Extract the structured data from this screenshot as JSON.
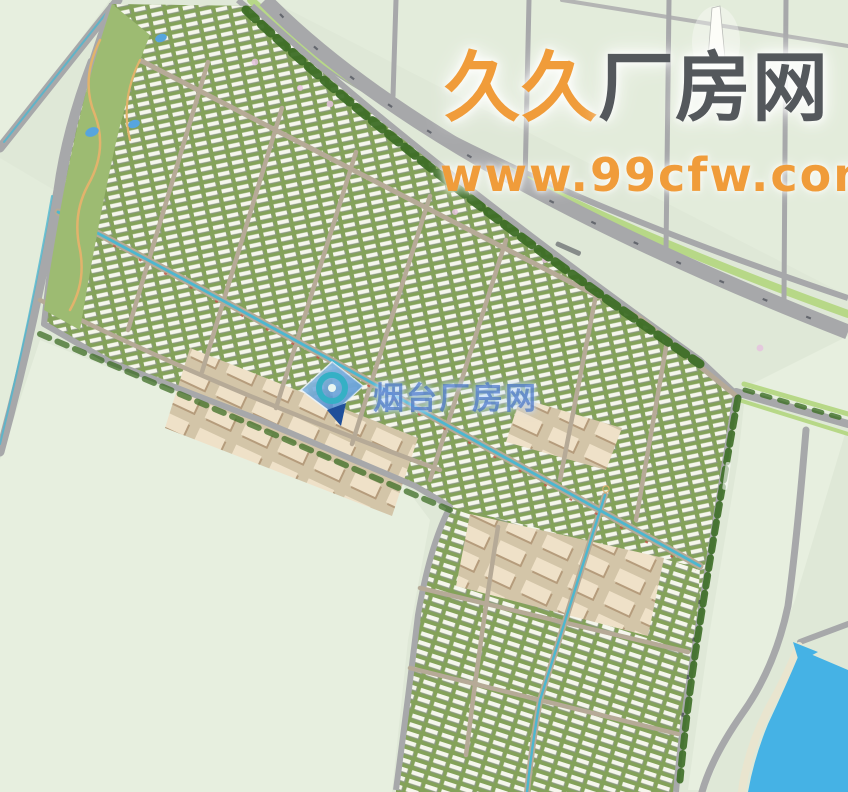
{
  "watermarks": {
    "primary": {
      "brand_prefix": "久久",
      "brand_suffix": "厂房网",
      "url": "www.99cfw.com"
    },
    "secondary": {
      "brand": "烟台厂房网",
      "logo": "diamond-ring-map-pin-logo"
    }
  },
  "map": {
    "kind": "industrial-park-master-plan-aerial-rendering",
    "features": [
      "open-farmland-fields",
      "diagonal-road-network",
      "tree-lined-boulevard",
      "industrial-building-rows",
      "large-warehouse-blocks",
      "canal-lined-avenue",
      "river-bottom-right",
      "small-ponds",
      "white-tower-landmark"
    ]
  },
  "theme": {
    "field": "#dfe8d7",
    "field-light": "#e7efdf",
    "field-mid": "#e3ecdb",
    "road": "#a7a8aa",
    "road-minor": "#b6aa97",
    "band-green": "#84a25a",
    "band-edge": "#9dbb72",
    "building-white": "#f5f6ec",
    "building-shadow": "#8d9a82",
    "big-ground": "#d3c5a8",
    "big-shadow": "#b59c7c",
    "big-fill": "#efe1c8",
    "tree-dark": "#3d6e26",
    "verge": "#b7d887",
    "canal": "#4db7cf",
    "river": "#45b2e5",
    "bank": "#e9e5cf",
    "pond": "#57a5de",
    "garden-path": "#e2b36c",
    "car-red": "#c05848",
    "car-dark": "#474c54",
    "wm-orange": "#f09c3a",
    "wm-dark": "#54585c",
    "wm-blue": "rgba(56,104,192,0.62)",
    "wm-blue-glow": "rgba(190,220,255,0.9)"
  }
}
